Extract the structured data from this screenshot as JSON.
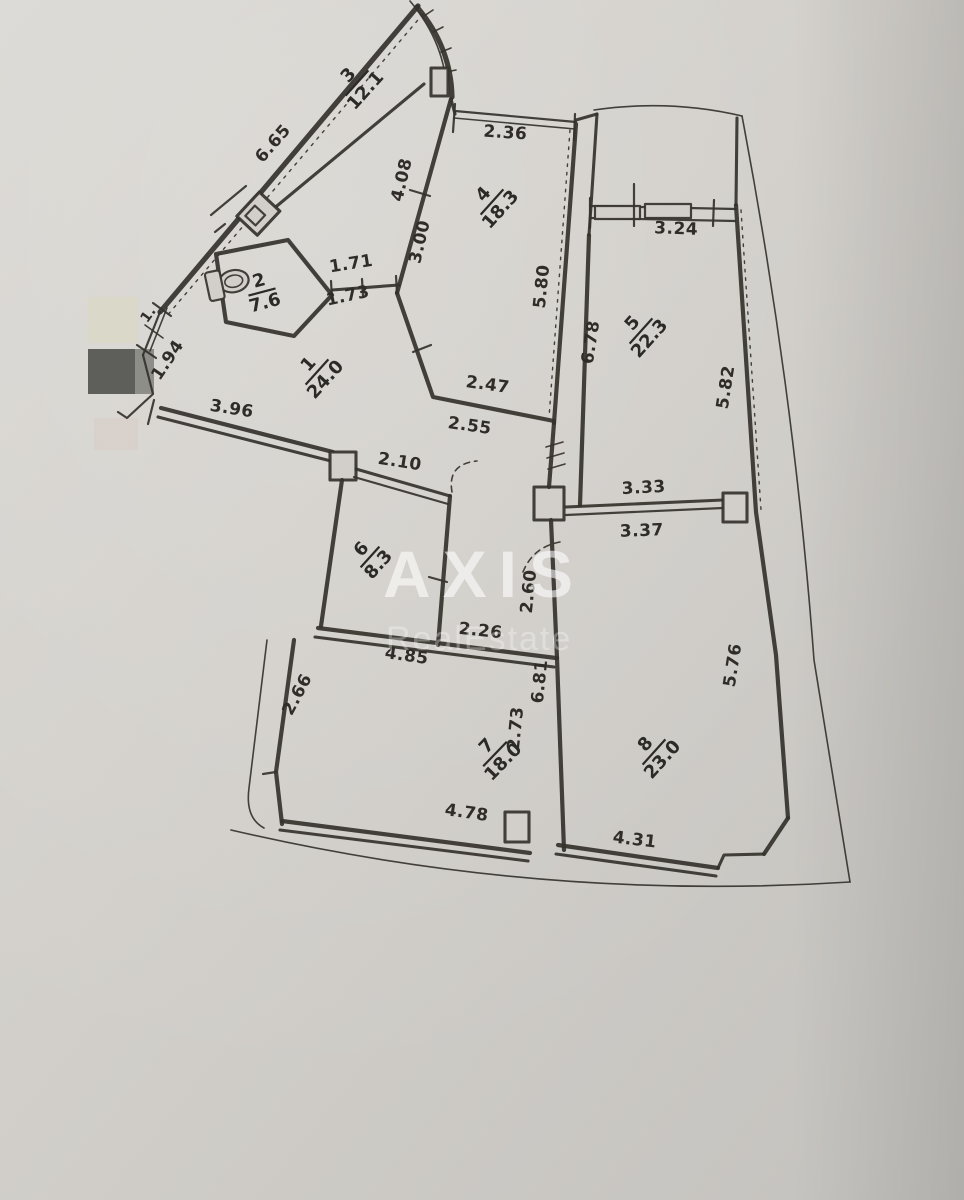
{
  "watermark": {
    "brand": "AXIS",
    "subtitle": "RealEstate"
  },
  "rooms": [
    {
      "number": "1",
      "area": "24.0"
    },
    {
      "number": "2",
      "area": "7.6"
    },
    {
      "number": "3",
      "area": "12.1"
    },
    {
      "number": "4",
      "area": "18.3"
    },
    {
      "number": "5",
      "area": "22.3"
    },
    {
      "number": "6",
      "area": "8.3"
    },
    {
      "number": "7",
      "area": "18.0"
    },
    {
      "number": "8",
      "area": "23.0"
    }
  ],
  "dims": {
    "d665": "6.65",
    "d1": "1.",
    "d194": "1.94",
    "d396": "3.96",
    "d408": "4.08",
    "d300": "3.00",
    "d236": "2.36",
    "d580": "5.80",
    "d324": "3.24",
    "d678": "6.78",
    "d582": "5.82",
    "d171": "1.71",
    "d173": "1.73",
    "d247": "2.47",
    "d255": "2.55",
    "d210": "2.10",
    "d333": "3.33",
    "d337": "3.37",
    "d260": "2.60",
    "d226": "2.26",
    "d485": "4.85",
    "d681": "6.81",
    "d266": "2.66",
    "d273": "2.73",
    "d478": "4.78",
    "d431": "4.31",
    "d576": "5.76"
  },
  "colors": {
    "paper": "#d2cfca",
    "ink": "#35322d",
    "redaction_dark": "#5e5e5b",
    "redaction_mid": "#8e8e89",
    "redaction_pale": "#d9d8c6",
    "watermark_strong": "rgba(255,255,255,0.58)",
    "watermark_soft": "rgba(255,255,255,0.30)"
  }
}
